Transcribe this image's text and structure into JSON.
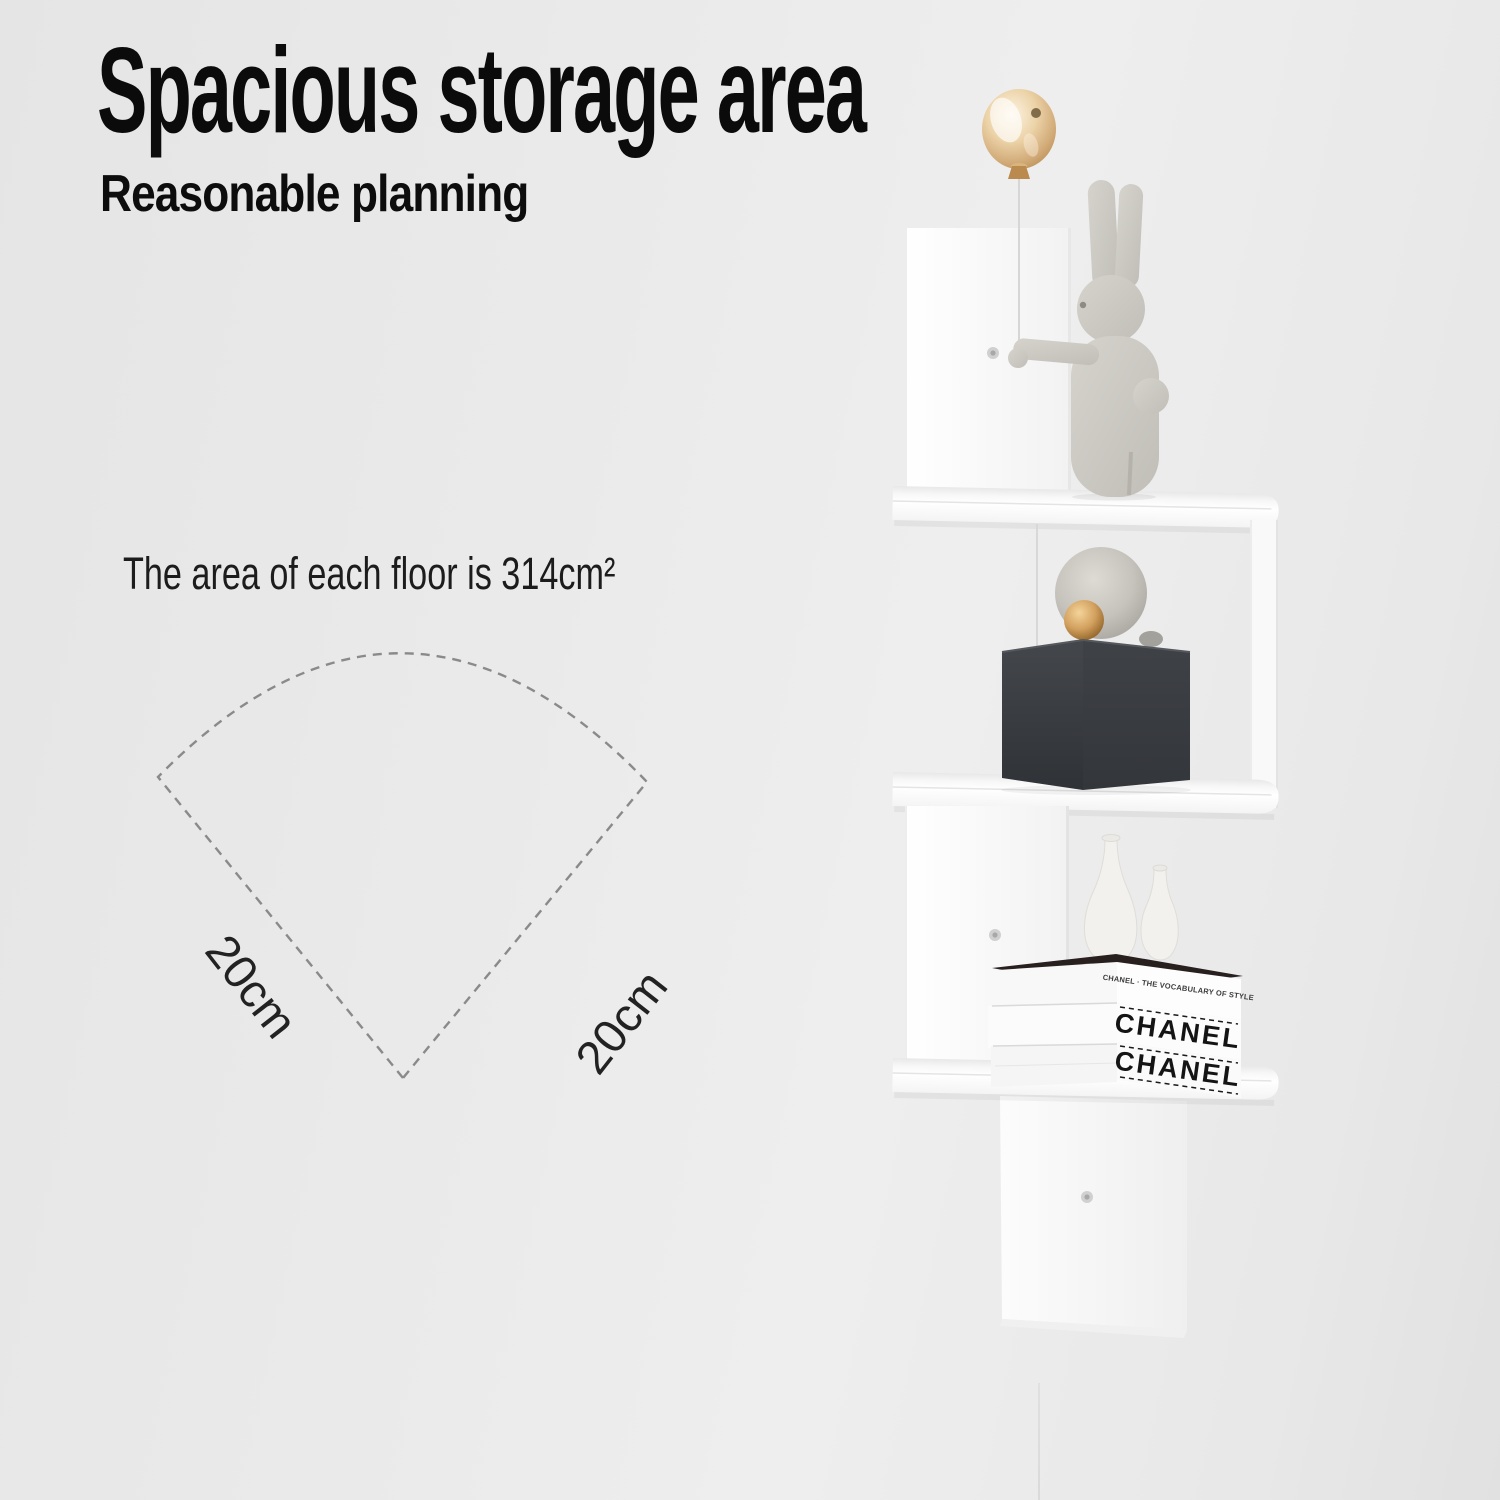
{
  "header": {
    "title": "Spacious storage area",
    "subtitle": "Reasonable planning"
  },
  "diagram": {
    "caption": "The area of each floor is 314cm²",
    "left_dimension": "20cm",
    "right_dimension": "20cm"
  },
  "shelf_photo": {
    "book_spines": {
      "top": "CHANEL · THE VOCABULARY OF STYLE",
      "middle": "CHANEL",
      "bottom": "CHANEL"
    }
  },
  "colors": {
    "wall": "#eaeaea",
    "heading_text": "#0b0b0b",
    "body_text": "#1c1c1c",
    "dash_line": "#8a8a8a",
    "shelf_white": "#fcfcfc",
    "cube_dark": "#3a3d41",
    "balloon_gold": "#e2c193",
    "gold_ball": "#c8955c",
    "bunny_gray": "#cbc8c2",
    "book_text": "#141414"
  }
}
